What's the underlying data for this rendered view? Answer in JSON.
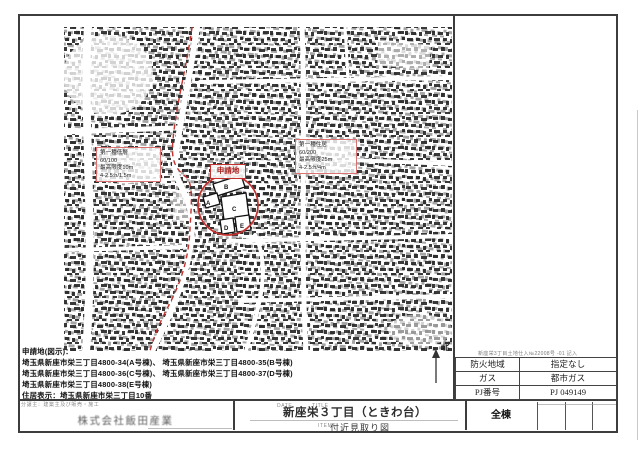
{
  "map": {
    "site_label": "申請地",
    "units": [
      "A",
      "B",
      "C",
      "D",
      "E"
    ],
    "compass_label": "北",
    "zoning_low": {
      "line1": "第一種低層",
      "line2": "60/100",
      "line3": "最高限度10m",
      "line4": "4-2.5:h/1.5m"
    },
    "zoning_res": {
      "line1": "第一種住居",
      "line2": "60/200",
      "line3": "最高限度25m",
      "line4": "4-2.5:h/4m"
    }
  },
  "notes": {
    "heading": "申請地(図示)：",
    "line1": "埼玉県新座市栄三丁目4800-34(A号棟)、 埼玉県新座市栄三丁目4800-35(B号棟)",
    "line2": "埼玉県新座市栄三丁目4800-36(C号棟)、 埼玉県新座市栄三丁目4800-37(D号棟)",
    "line3": "埼玉県新座市栄三丁目4800-38(E号棟)",
    "address_display": "住居表示：埼玉県新座市栄三丁目10番"
  },
  "info_table": {
    "note_above": "新座栄3丁目土地仕入№22008号 -01 記入",
    "rows": [
      {
        "label": "防火地域",
        "value": "指定なし"
      },
      {
        "label": "ガス",
        "value": "都市ガス"
      },
      {
        "label": "PJ番号",
        "value": "PJ 049149"
      }
    ]
  },
  "title_block": {
    "seller_note": "分譲主：建築主及び販売・施工",
    "company": "株式会社飯田産業",
    "date_label": "DATE",
    "title_label": "TITLE",
    "items_label": "ITEMS",
    "project_title": "新座栄３丁目（ときわ台）",
    "scope": "全棟",
    "drawing_title": "付近見取り図"
  },
  "colors": {
    "boundary_red": "#c4312e",
    "frame_gray": "#3d3d3d"
  }
}
